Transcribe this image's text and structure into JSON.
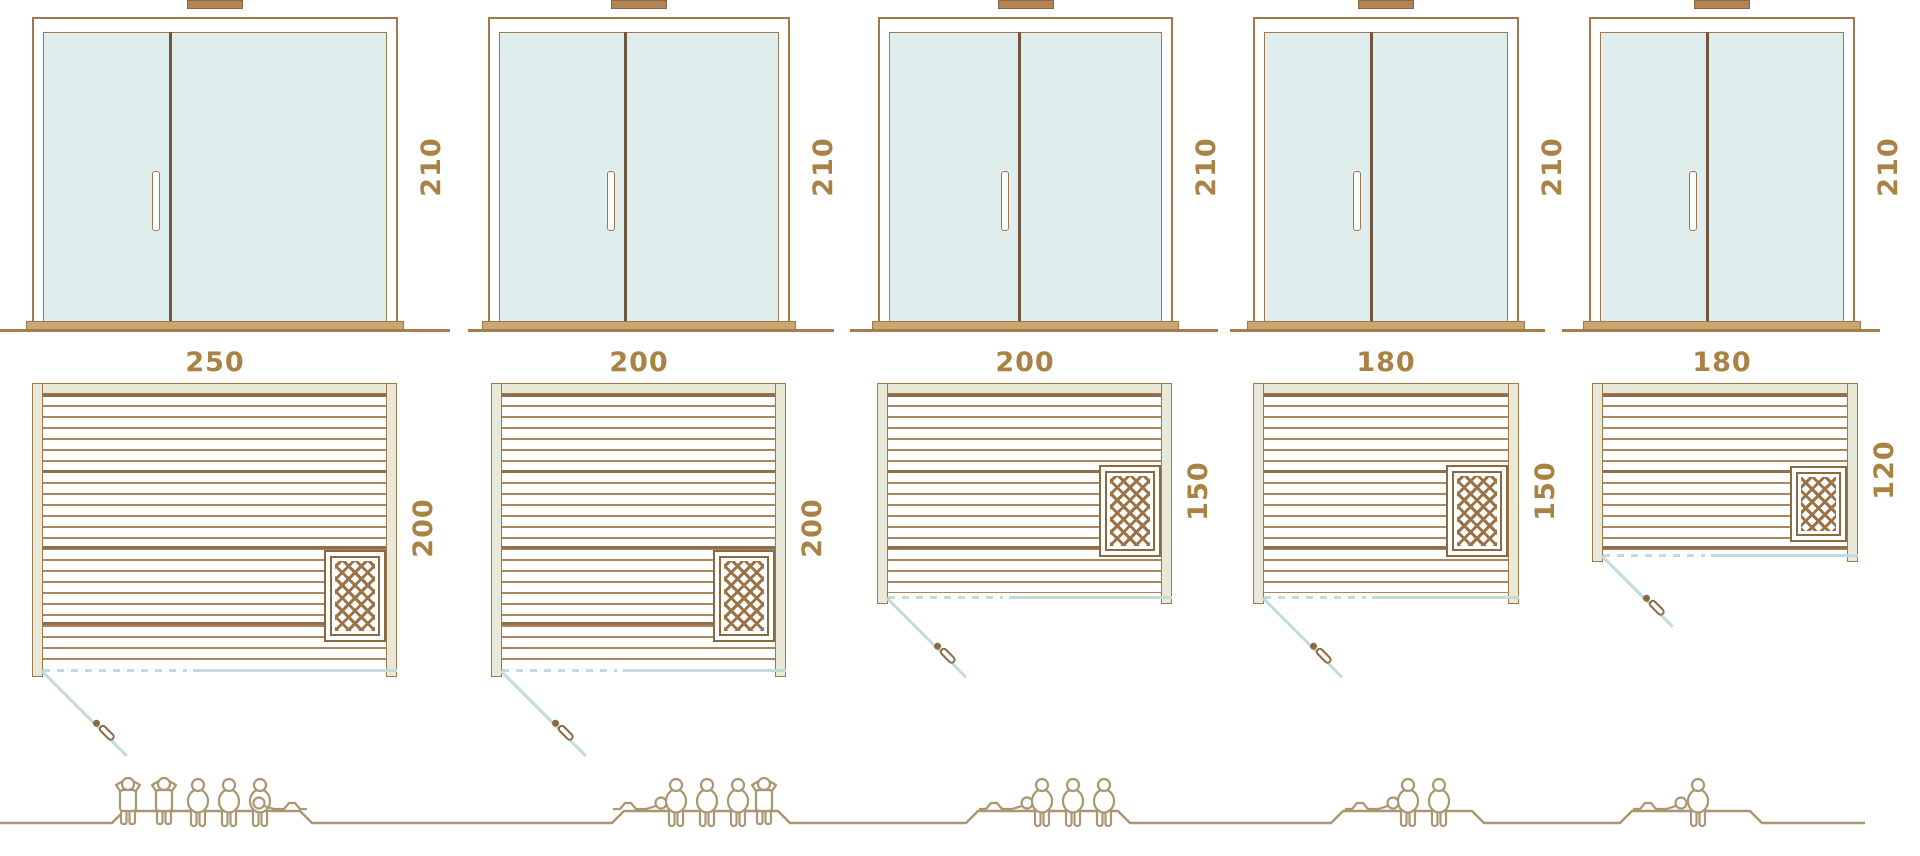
{
  "diagram": {
    "kind": "sauna size comparison diagram",
    "rows": [
      "door elevation",
      "floor plan",
      "seating capacity"
    ]
  },
  "colors": {
    "outline_brown": "#9c7a4e",
    "dark_divider": "#6d5740",
    "ground_brown": "#a57e4e",
    "sill_tan": "#c9a674",
    "label_gold": "#a98343",
    "glass_mint": "#dfeeec",
    "wall_beige": "#eae9d7",
    "plank_brown": "#ab8760",
    "plank_dark": "#8f6f4a",
    "heater_brown": "#9b7347",
    "vent_brown": "#b08454",
    "swing_blue": "#c2ddd9",
    "people_brown": "#ab9672",
    "background": "#ffffff"
  },
  "units": [
    {
      "name": "sauna-250x200",
      "height_label": "210",
      "width_label": "250",
      "depth_label": "200",
      "people": [
        "standing",
        "standing",
        "sitting",
        "sitting",
        "sitting",
        "lying"
      ],
      "capacity": 6
    },
    {
      "name": "sauna-200x200",
      "height_label": "210",
      "width_label": "200",
      "depth_label": "200",
      "people": [
        "lying",
        "sitting",
        "sitting",
        "sitting",
        "standing"
      ],
      "capacity": 5
    },
    {
      "name": "sauna-200x150",
      "height_label": "210",
      "width_label": "200",
      "depth_label": "150",
      "people": [
        "lying",
        "sitting",
        "sitting",
        "sitting"
      ],
      "capacity": 4
    },
    {
      "name": "sauna-180x150",
      "height_label": "210",
      "width_label": "180",
      "depth_label": "150",
      "people": [
        "lying",
        "sitting",
        "sitting"
      ],
      "capacity": 3
    },
    {
      "name": "sauna-180x120",
      "height_label": "210",
      "width_label": "180",
      "depth_label": "120",
      "people": [
        "lying",
        "sitting"
      ],
      "capacity": 2
    }
  ]
}
